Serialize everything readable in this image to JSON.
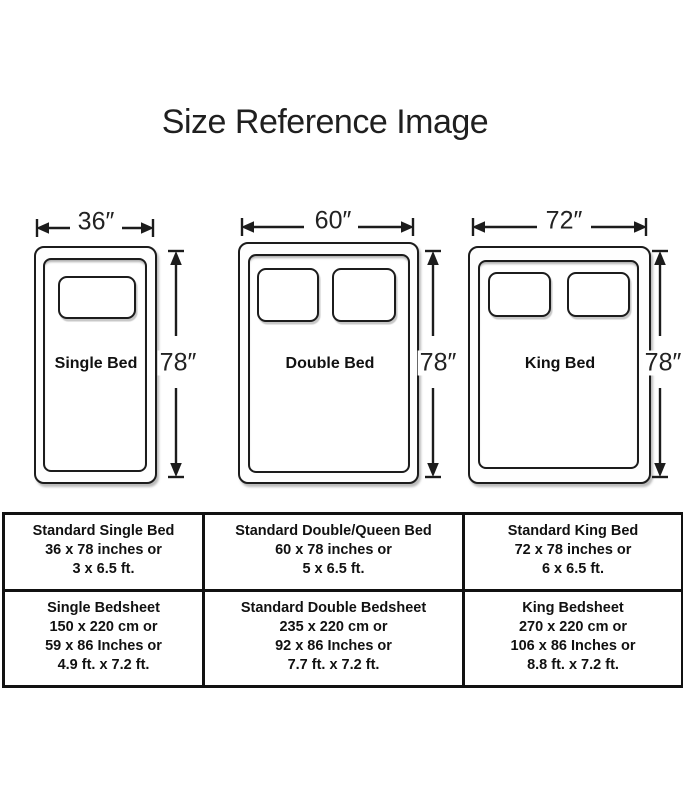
{
  "title": "Size Reference Image",
  "beds": [
    {
      "name": "Single Bed",
      "width_label": "36″",
      "height_label": "78″"
    },
    {
      "name": "Double Bed",
      "width_label": "60″",
      "height_label": "78″"
    },
    {
      "name": "King Bed",
      "width_label": "72″",
      "height_label": "78″"
    }
  ],
  "table": {
    "rows": [
      {
        "cells": [
          {
            "lines": [
              "Standard Single Bed",
              "36 x 78 inches or",
              "3 x 6.5 ft."
            ]
          },
          {
            "lines": [
              "Standard Double/Queen Bed",
              "60 x 78 inches or",
              "5 x 6.5 ft."
            ]
          },
          {
            "lines": [
              "Standard King Bed",
              "72 x 78 inches or",
              "6 x 6.5 ft."
            ]
          }
        ]
      },
      {
        "cells": [
          {
            "lines": [
              "Single Bedsheet",
              "150 x 220 cm or",
              "59 x 86 Inches or",
              "4.9 ft. x 7.2 ft."
            ]
          },
          {
            "lines": [
              "Standard Double Bedsheet",
              "235 x 220 cm or",
              "92 x 86 Inches or",
              "7.7 ft. x 7.2 ft."
            ]
          },
          {
            "lines": [
              "King Bedsheet",
              "270 x 220 cm or",
              "106 x 86 Inches or",
              "8.8 ft. x 7.2 ft."
            ]
          }
        ]
      }
    ]
  },
  "colors": {
    "ink": "#1c1c1c",
    "background": "#ffffff"
  }
}
